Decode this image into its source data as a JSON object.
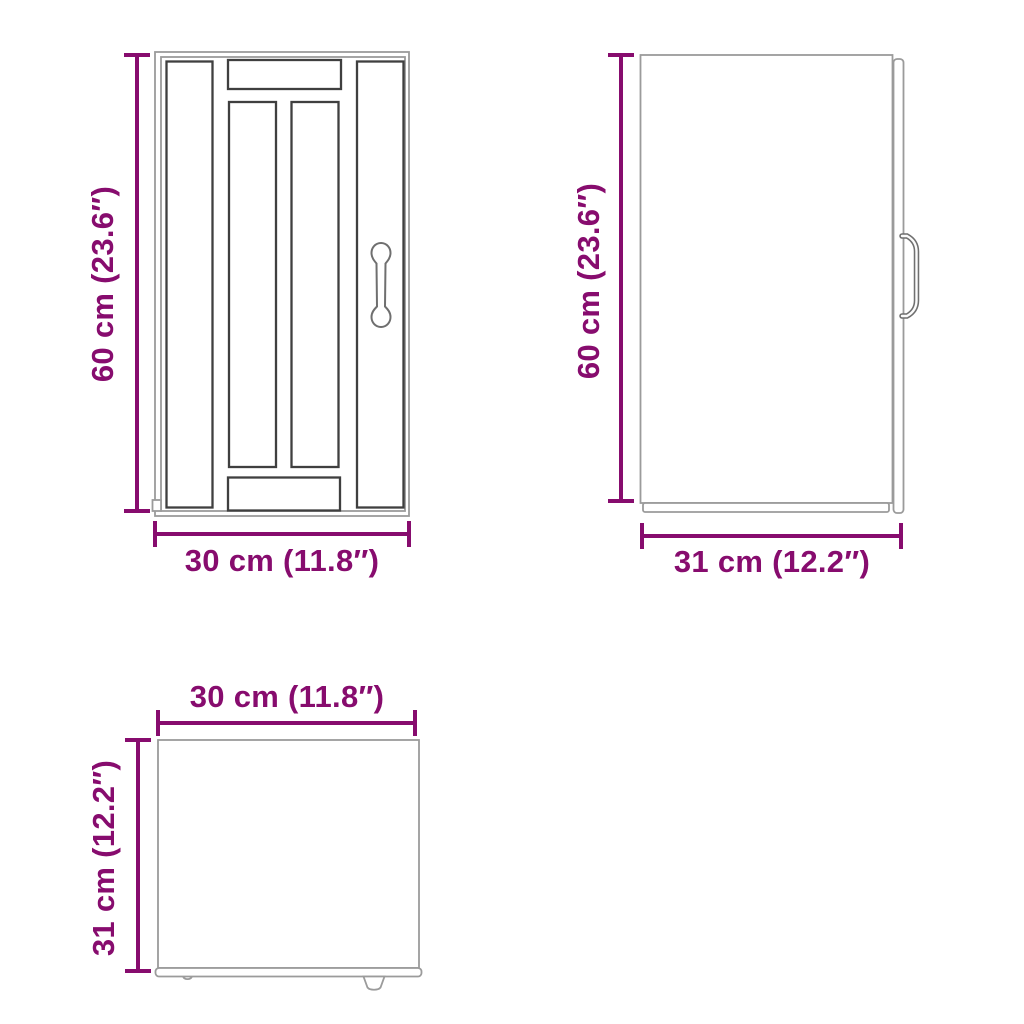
{
  "colors": {
    "dimension": "#870c6e",
    "outline_light": "#9b9b9b",
    "outline_dark": "#3f3f3f",
    "handle": "#6f6f6f"
  },
  "views": {
    "front": {
      "height_label": "60 cm (23.6″)",
      "width_label": "30 cm (11.8″)"
    },
    "side": {
      "height_label": "60 cm (23.6″)",
      "depth_label": "31 cm (12.2″)"
    },
    "top": {
      "width_label": "30 cm (11.8″)",
      "depth_label": "31 cm (12.2″)"
    }
  }
}
